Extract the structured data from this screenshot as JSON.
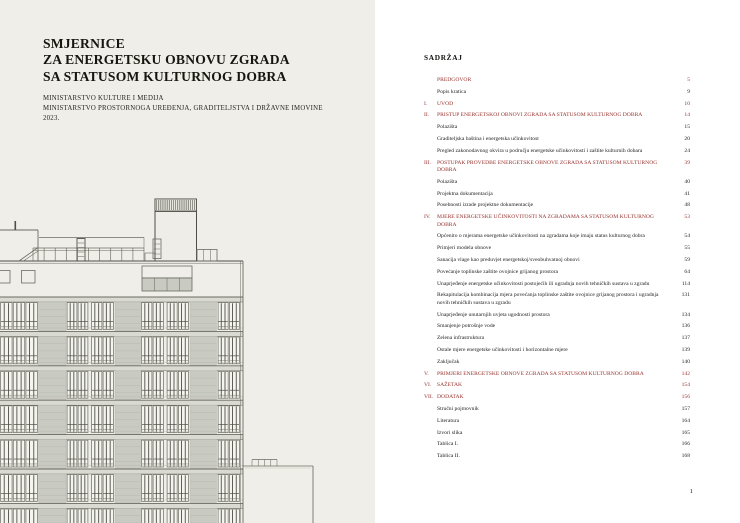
{
  "cover": {
    "title_lines": [
      "SMJERNICE",
      "ZA ENERGETSKU OBNOVU ZGRADA",
      "SA STATUSOM KULTURNOG DOBRA"
    ],
    "subtitle_lines": [
      "MINISTARSTVO KULTURE I MEDIJA",
      "MINISTARSTVO PROSTORNOGA UREĐENJA, GRADITELJSTVA I DRŽAVNE IMOVINE",
      "2023."
    ]
  },
  "toc": {
    "heading": "SADRŽAJ",
    "entries": [
      {
        "num": "",
        "label": "PREDGOVOR",
        "page": "5",
        "style": "section"
      },
      {
        "num": "",
        "label": "Popis kratica",
        "page": "9",
        "style": "item"
      },
      {
        "num": "I.",
        "label": "UVOD",
        "page": "10",
        "style": "section"
      },
      {
        "num": "II.",
        "label": "PRISTUP ENERGETSKOJ OBNOVI ZGRADA SA STATUSOM KULTURNOG DOBRA",
        "page": "14",
        "style": "section"
      },
      {
        "num": "",
        "label": "Polazišta",
        "page": "15",
        "style": "item"
      },
      {
        "num": "",
        "label": "Graditeljska baština i energetska učinkovitost",
        "page": "20",
        "style": "item"
      },
      {
        "num": "",
        "label": "Pregled zakonodavnog okvira u području energetske učinkovitosti i zaštite kulturnih dobara",
        "page": "24",
        "style": "item"
      },
      {
        "num": "III.",
        "label": "POSTUPAK PROVEDBE ENERGETSKE OBNOVE ZGRADA SA STATUSOM KULTURNOG DOBRA",
        "page": "39",
        "style": "section"
      },
      {
        "num": "",
        "label": "Polazišta",
        "page": "40",
        "style": "item"
      },
      {
        "num": "",
        "label": "Projektna dokumentacija",
        "page": "41",
        "style": "item"
      },
      {
        "num": "",
        "label": "Posebnosti izrade projektne dokumentacije",
        "page": "48",
        "style": "item"
      },
      {
        "num": "IV.",
        "label": "MJERE ENERGETSKE UČINKOVITOSTI NA ZGRADAMA SA STATUSOM KULTURNOG DOBRA",
        "page": "53",
        "style": "section"
      },
      {
        "num": "",
        "label": "Općenito o mjerama energetske učinkovitosti na zgradama koje imaju status kulturnog dobra",
        "page": "54",
        "style": "item"
      },
      {
        "num": "",
        "label": "Primjeri modela obnove",
        "page": "55",
        "style": "item"
      },
      {
        "num": "",
        "label": "Sanacija vlage kao preduvjet energetskoj/sveobuhvatnoj obnovi",
        "page": "59",
        "style": "item"
      },
      {
        "num": "",
        "label": "Povećanje toplinske zaštite ovojnice grijanog prostora",
        "page": "64",
        "style": "item"
      },
      {
        "num": "",
        "label": "Unaprjeđenje energetske učinkovitosti postojećih ili ugradnja novih tehničkih sustava u zgradu",
        "page": "114",
        "style": "item"
      },
      {
        "num": "",
        "label": "Rekapitulacija kombinacija mjera povećanja toplinske zaštite ovojnice grijanog prostora i ugradnja novih tehničkih sustava u zgradu",
        "page": "131",
        "style": "item"
      },
      {
        "num": "",
        "label": "Unaprjeđenje unutarnjih uvjeta ugodnosti prostora",
        "page": "134",
        "style": "item"
      },
      {
        "num": "",
        "label": "Smanjenje potrošnje vode",
        "page": "136",
        "style": "item"
      },
      {
        "num": "",
        "label": "Zelena infrastruktura",
        "page": "137",
        "style": "item"
      },
      {
        "num": "",
        "label": "Ostale mjere energetske učinkovitosti i horizontalne mjere",
        "page": "139",
        "style": "item"
      },
      {
        "num": "",
        "label": "Zaključak",
        "page": "140",
        "style": "item"
      },
      {
        "num": "V.",
        "label": "PRIMJERI ENERGETSKE OBNOVE ZGRADA SA STATUSOM KULTURNOG DOBRA",
        "page": "142",
        "style": "section"
      },
      {
        "num": "VI.",
        "label": "SAŽETAK",
        "page": "154",
        "style": "section"
      },
      {
        "num": "VII.",
        "label": "DODATAK",
        "page": "156",
        "style": "section"
      },
      {
        "num": "",
        "label": "Stručni pojmovnik",
        "page": "157",
        "style": "item"
      },
      {
        "num": "",
        "label": "Literatura",
        "page": "164",
        "style": "item"
      },
      {
        "num": "",
        "label": "Izvori slika",
        "page": "165",
        "style": "item"
      },
      {
        "num": "",
        "label": "Tablica I.",
        "page": "166",
        "style": "item"
      },
      {
        "num": "",
        "label": "Tablica II.",
        "page": "168",
        "style": "item"
      }
    ],
    "page_number": "1"
  },
  "colors": {
    "accent_red": "#97322d",
    "left_page_bg": "#efeee8",
    "right_page_bg": "#ffffff",
    "text": "#1d1d1b"
  },
  "drawing": {
    "type": "building-elevation",
    "palette": {
      "line": "#6b6b62",
      "dark": "#4f4f48",
      "panel": "#c9cbc2",
      "panel_line": "#b7b9b0",
      "pane": "#f5f5ef",
      "band": "#d9dad2",
      "wall": "#eeede7"
    },
    "roofline_y": 261,
    "right_edge_x": 243,
    "floors": {
      "start_y": 297,
      "pitch": 34.4,
      "band_h": 5,
      "count": 7
    },
    "bays": [
      {
        "kind": "w",
        "x": 0,
        "w": 38,
        "n": 3
      },
      {
        "kind": "p",
        "x": 38.5,
        "w": 27.5
      },
      {
        "kind": "w",
        "x": 66.5,
        "w": 22,
        "n": 2
      },
      {
        "kind": "w",
        "x": 91,
        "w": 23,
        "n": 2
      },
      {
        "kind": "p",
        "x": 115,
        "w": 25.5
      },
      {
        "kind": "w",
        "x": 141,
        "w": 23,
        "n": 2
      },
      {
        "kind": "w",
        "x": 166.5,
        "w": 22.5,
        "n": 2
      },
      {
        "kind": "p",
        "x": 190,
        "w": 26.5
      },
      {
        "kind": "w",
        "x": 217.5,
        "w": 22.5,
        "n": 2
      }
    ],
    "tower": {
      "x": 155,
      "w": 41.5,
      "top_y": 199,
      "hatch_h": 12
    },
    "annex": {
      "x": 243,
      "right_x": 313,
      "top_y": 466,
      "rail_x": 252,
      "rail_w": 25,
      "rail_y": 459.5
    }
  }
}
